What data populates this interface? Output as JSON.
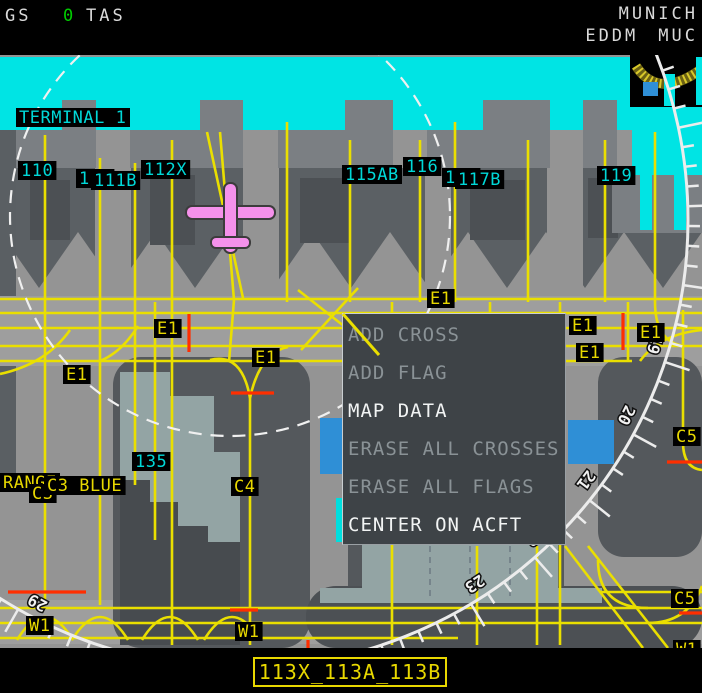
{
  "header": {
    "gs_label": "GS",
    "gs_value": "0",
    "tas_label": "TAS",
    "airport_name": "MUNICH",
    "airport_icao": "EDDM",
    "airport_iata": "MUC"
  },
  "context_menu": {
    "items": [
      {
        "label": "ADD CROSS",
        "enabled": false
      },
      {
        "label": "ADD FLAG",
        "enabled": false
      },
      {
        "label": "MAP DATA",
        "enabled": true
      },
      {
        "label": "ERASE ALL CROSSES",
        "enabled": false
      },
      {
        "label": "ERASE ALL FLAGS",
        "enabled": false
      },
      {
        "label": "CENTER ON ACFT",
        "enabled": true
      }
    ]
  },
  "map": {
    "bottom_label": "113X_113A_113B",
    "labels_cyan": [
      {
        "text": "TERMINAL 1",
        "x": 16,
        "y": 108
      },
      {
        "text": "110",
        "x": 18,
        "y": 161
      },
      {
        "text": "111",
        "x": 76,
        "y": 169
      },
      {
        "text": "111B",
        "x": 91,
        "y": 171
      },
      {
        "text": "112X",
        "x": 141,
        "y": 160
      },
      {
        "text": "115AB",
        "x": 342,
        "y": 165
      },
      {
        "text": "116",
        "x": 403,
        "y": 157
      },
      {
        "text": "117",
        "x": 442,
        "y": 168
      },
      {
        "text": "117B",
        "x": 455,
        "y": 170
      },
      {
        "text": "119",
        "x": 597,
        "y": 166
      },
      {
        "text": "135",
        "x": 132,
        "y": 452
      }
    ],
    "labels_yellow": [
      {
        "text": "E1",
        "x": 63,
        "y": 365
      },
      {
        "text": "E1",
        "x": 154,
        "y": 319
      },
      {
        "text": "E1",
        "x": 252,
        "y": 348
      },
      {
        "text": "E1",
        "x": 427,
        "y": 289
      },
      {
        "text": "E1",
        "x": 569,
        "y": 316
      },
      {
        "text": "E1",
        "x": 637,
        "y": 323
      },
      {
        "text": "E1",
        "x": 576,
        "y": 343
      },
      {
        "text": "RANGE",
        "x": 0,
        "y": 473
      },
      {
        "text": "C3",
        "x": 29,
        "y": 484
      },
      {
        "text": "C3 BLUE",
        "x": 44,
        "y": 476
      },
      {
        "text": "C4",
        "x": 231,
        "y": 477
      },
      {
        "text": "C5",
        "x": 673,
        "y": 427
      },
      {
        "text": "C5",
        "x": 671,
        "y": 589
      },
      {
        "text": "W1",
        "x": 26,
        "y": 616
      },
      {
        "text": "W1",
        "x": 235,
        "y": 622
      },
      {
        "text": "W1",
        "x": 673,
        "y": 640
      }
    ],
    "compass_headings": [
      "19",
      "20",
      "21",
      "22",
      "23",
      "29"
    ],
    "colors": {
      "terminal_cyan": "#00e4e4",
      "taxi_yellow": "#eadf00",
      "stopbar_red": "#ff2e00",
      "aircraft_pink": "#f591eb",
      "label_cyan": "#00d8d8",
      "label_yellow": "#e8d800",
      "menu_enabled_text": "#f2f4f4",
      "menu_disabled_text": "#8a9296",
      "gs_value_green": "#00cc00",
      "building_blue": "#2f8fd6"
    }
  }
}
